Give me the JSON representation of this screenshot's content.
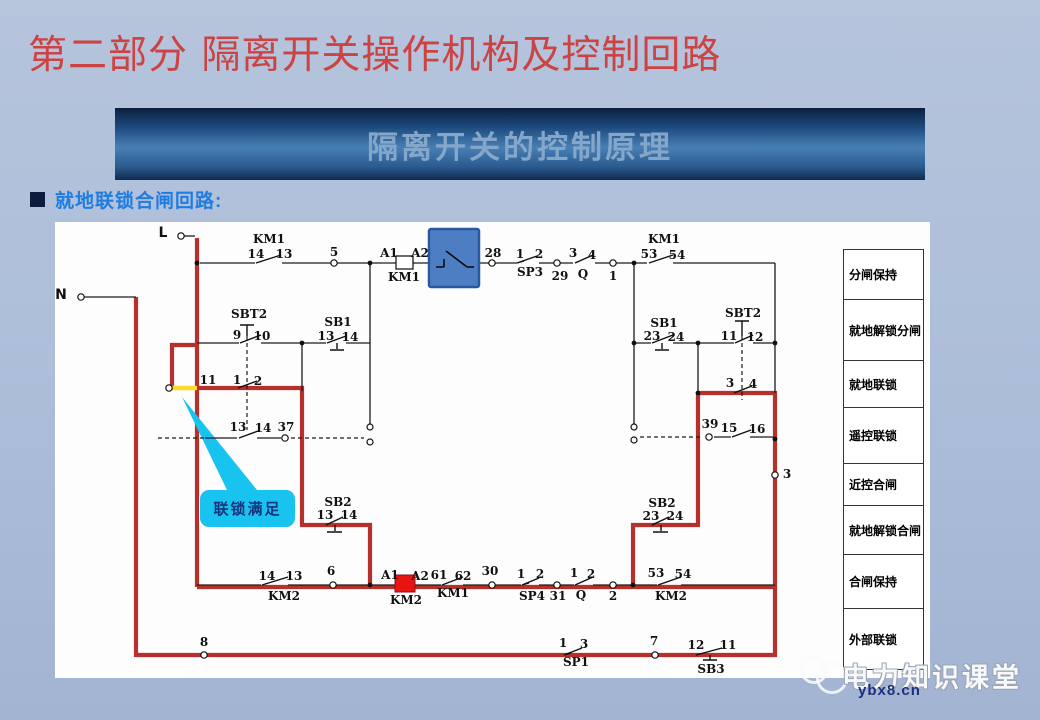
{
  "page": {
    "title": "第二部分 隔离开关操作机构及控制回路",
    "banner": "隔离开关的控制原理",
    "bullet": "就地联锁合闸回路:"
  },
  "colors": {
    "highlight_path_red": "#b7312c",
    "highlight_yellow": "#ffd92e",
    "highlight_box_blue": "#4d7ec4",
    "coil_highlight_red": "#e81414",
    "callout_cyan": "#19c3ef",
    "title_red": "#cb4343",
    "bullet_blue": "#1f7ce0"
  },
  "callout": {
    "label": "联锁满足"
  },
  "side_table": {
    "rows": [
      "分闸保持",
      "就地解锁分闸",
      "就地联锁",
      "遥控联锁",
      "近控合闸",
      "就地解锁合闸",
      "合闸保持",
      "外部联锁"
    ]
  },
  "watermark": {
    "brand": "电力知识课堂",
    "domain": "ybx8.cn"
  },
  "diagram": {
    "labels": [
      {
        "t": "L",
        "x": 108,
        "y": 4,
        "c": "big"
      },
      {
        "t": "N",
        "x": 6,
        "y": 66,
        "c": "big"
      },
      {
        "t": "KM1",
        "x": 214,
        "y": 11
      },
      {
        "t": "14",
        "x": 201,
        "y": 26
      },
      {
        "t": "13",
        "x": 229,
        "y": 26
      },
      {
        "t": "5",
        "x": 279,
        "y": 24
      },
      {
        "t": "A1",
        "x": 334,
        "y": 25
      },
      {
        "t": "A2",
        "x": 365,
        "y": 25
      },
      {
        "t": "KM1",
        "x": 349,
        "y": 49
      },
      {
        "t": "28",
        "x": 438,
        "y": 25
      },
      {
        "t": "1",
        "x": 465,
        "y": 26
      },
      {
        "t": "2",
        "x": 484,
        "y": 26
      },
      {
        "t": "SP3",
        "x": 475,
        "y": 44
      },
      {
        "t": "29",
        "x": 505,
        "y": 48
      },
      {
        "t": "3",
        "x": 518,
        "y": 25
      },
      {
        "t": "Q",
        "x": 528,
        "y": 46
      },
      {
        "t": "4",
        "x": 537,
        "y": 27
      },
      {
        "t": "1",
        "x": 558,
        "y": 48
      },
      {
        "t": "53",
        "x": 594,
        "y": 26
      },
      {
        "t": "KM1",
        "x": 609,
        "y": 11
      },
      {
        "t": "54",
        "x": 622,
        "y": 27
      },
      {
        "t": "SBT2",
        "x": 194,
        "y": 86
      },
      {
        "t": "9",
        "x": 182,
        "y": 107
      },
      {
        "t": "10",
        "x": 207,
        "y": 108
      },
      {
        "t": "SB1",
        "x": 283,
        "y": 94
      },
      {
        "t": "13",
        "x": 271,
        "y": 108
      },
      {
        "t": "14",
        "x": 295,
        "y": 109
      },
      {
        "t": "11",
        "x": 153,
        "y": 152
      },
      {
        "t": "1",
        "x": 182,
        "y": 152
      },
      {
        "t": "2",
        "x": 203,
        "y": 153
      },
      {
        "t": "13",
        "x": 183,
        "y": 199
      },
      {
        "t": "14",
        "x": 208,
        "y": 200
      },
      {
        "t": "37",
        "x": 231,
        "y": 199
      },
      {
        "t": "SB1",
        "x": 609,
        "y": 95
      },
      {
        "t": "23",
        "x": 597,
        "y": 108
      },
      {
        "t": "24",
        "x": 621,
        "y": 109
      },
      {
        "t": "SBT2",
        "x": 688,
        "y": 85
      },
      {
        "t": "11",
        "x": 674,
        "y": 108
      },
      {
        "t": "12",
        "x": 700,
        "y": 109
      },
      {
        "t": "3",
        "x": 675,
        "y": 155
      },
      {
        "t": "4",
        "x": 698,
        "y": 156
      },
      {
        "t": "39",
        "x": 655,
        "y": 196
      },
      {
        "t": "15",
        "x": 674,
        "y": 200
      },
      {
        "t": "16",
        "x": 702,
        "y": 201
      },
      {
        "t": "3",
        "x": 732,
        "y": 246
      },
      {
        "t": "SB2",
        "x": 283,
        "y": 274
      },
      {
        "t": "13",
        "x": 270,
        "y": 287
      },
      {
        "t": "14",
        "x": 294,
        "y": 287
      },
      {
        "t": "SB2",
        "x": 607,
        "y": 275
      },
      {
        "t": "23",
        "x": 596,
        "y": 288
      },
      {
        "t": "24",
        "x": 620,
        "y": 288
      },
      {
        "t": "14",
        "x": 212,
        "y": 348
      },
      {
        "t": "13",
        "x": 239,
        "y": 348
      },
      {
        "t": "KM2",
        "x": 229,
        "y": 368
      },
      {
        "t": "6",
        "x": 276,
        "y": 343
      },
      {
        "t": "A1",
        "x": 335,
        "y": 347
      },
      {
        "t": "A2",
        "x": 365,
        "y": 348
      },
      {
        "t": "KM2",
        "x": 351,
        "y": 372
      },
      {
        "t": "61",
        "x": 384,
        "y": 347
      },
      {
        "t": "62",
        "x": 408,
        "y": 348
      },
      {
        "t": "KM1",
        "x": 398,
        "y": 365
      },
      {
        "t": "30",
        "x": 435,
        "y": 343
      },
      {
        "t": "1",
        "x": 466,
        "y": 346
      },
      {
        "t": "2",
        "x": 485,
        "y": 346
      },
      {
        "t": "SP4",
        "x": 477,
        "y": 368
      },
      {
        "t": "31",
        "x": 503,
        "y": 368
      },
      {
        "t": "1",
        "x": 519,
        "y": 345
      },
      {
        "t": "2",
        "x": 536,
        "y": 346
      },
      {
        "t": "Q",
        "x": 526,
        "y": 367
      },
      {
        "t": "2",
        "x": 558,
        "y": 368
      },
      {
        "t": "53",
        "x": 601,
        "y": 345
      },
      {
        "t": "54",
        "x": 628,
        "y": 346
      },
      {
        "t": "KM2",
        "x": 616,
        "y": 368
      },
      {
        "t": "8",
        "x": 149,
        "y": 414
      },
      {
        "t": "1",
        "x": 508,
        "y": 415
      },
      {
        "t": "3",
        "x": 529,
        "y": 416
      },
      {
        "t": "SP1",
        "x": 521,
        "y": 434
      },
      {
        "t": "7",
        "x": 599,
        "y": 413
      },
      {
        "t": "12",
        "x": 641,
        "y": 417
      },
      {
        "t": "11",
        "x": 673,
        "y": 417
      },
      {
        "t": "SB3",
        "x": 656,
        "y": 441
      }
    ]
  }
}
